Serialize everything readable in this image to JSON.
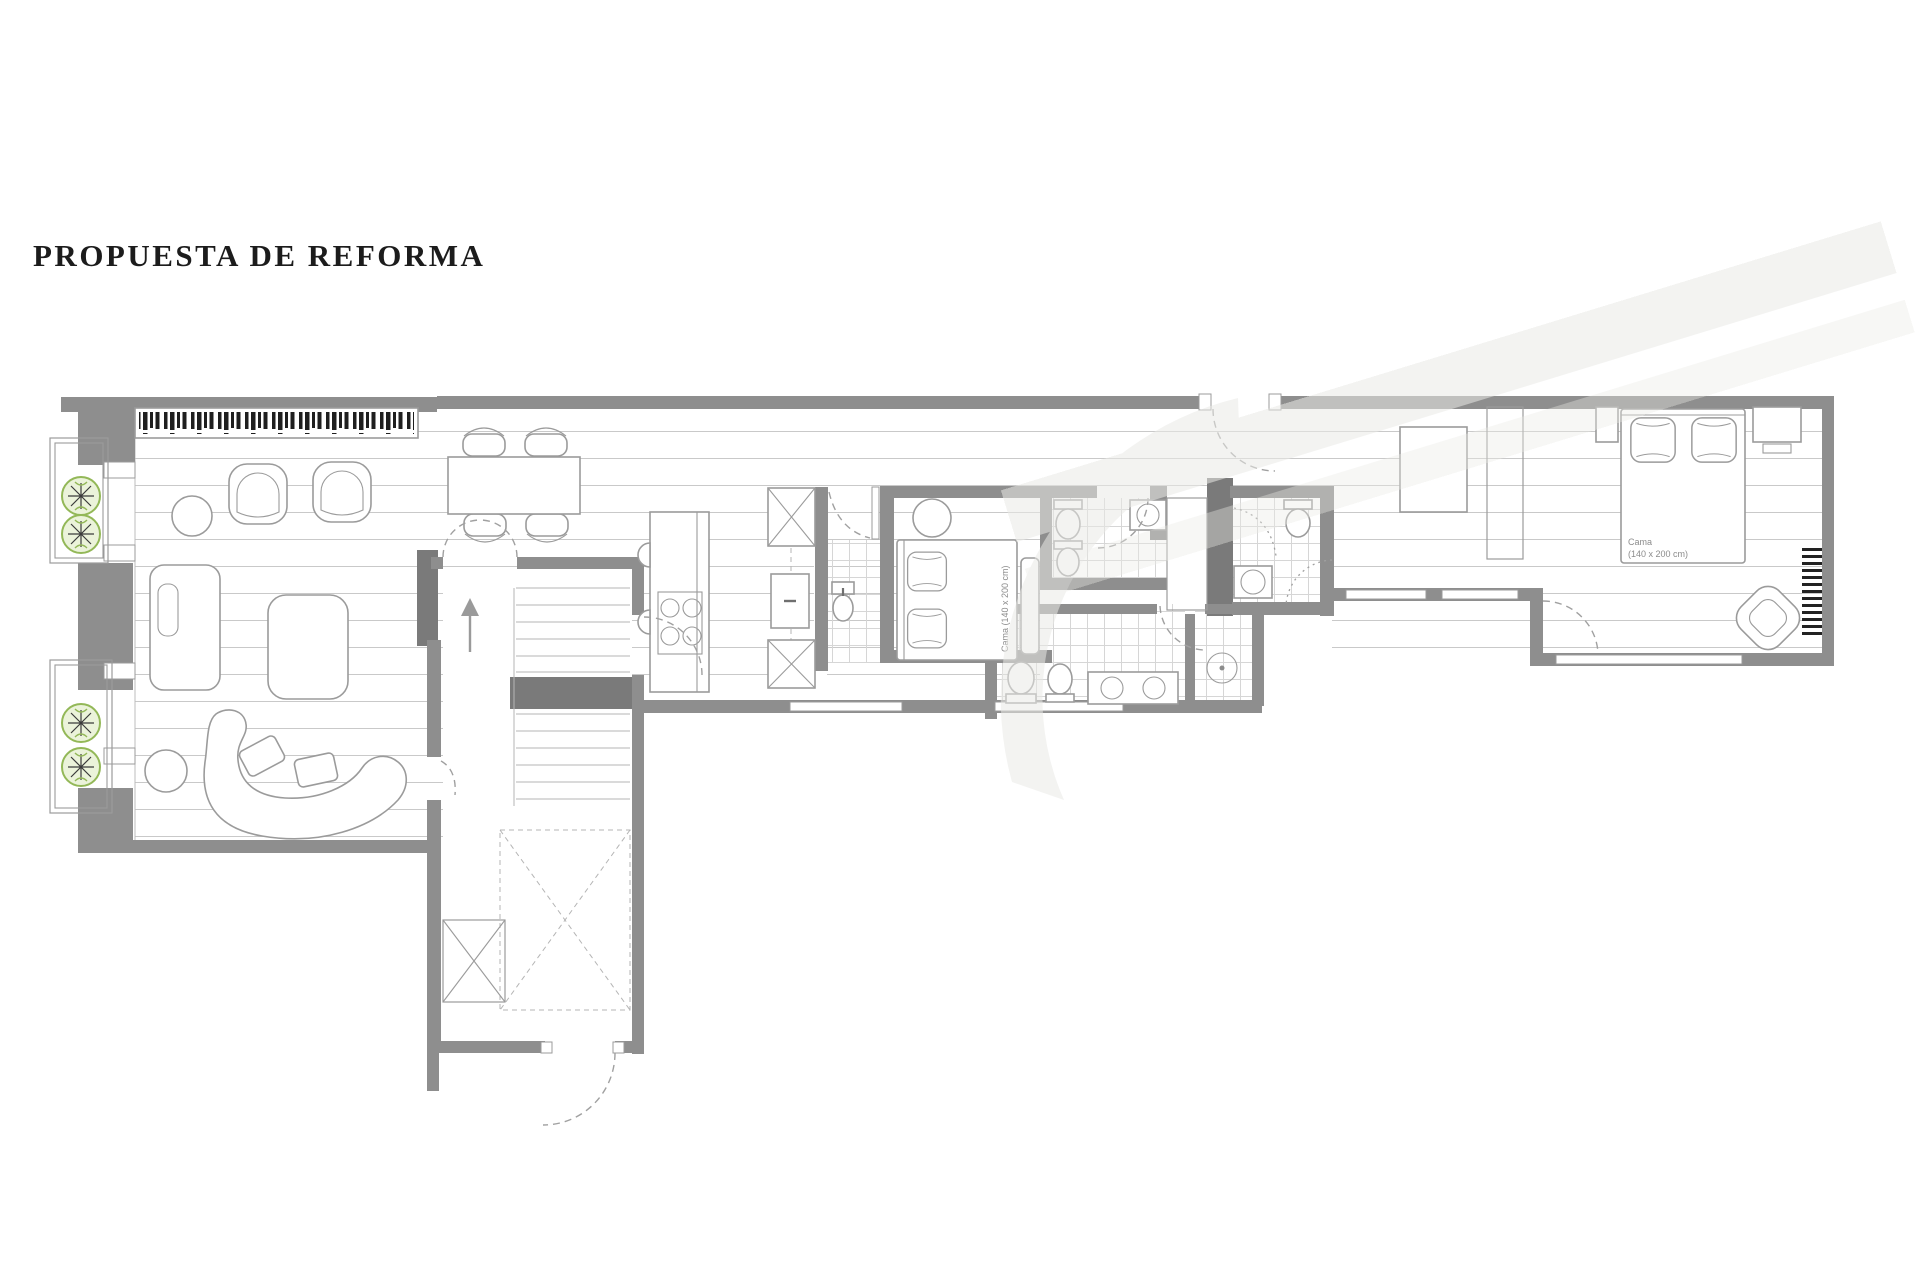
{
  "title": "PROPUESTA DE REFORMA",
  "plan": {
    "labels": {
      "middle_bed": "Cama (140 x 200 cm)",
      "master_bed_name": "Cama",
      "master_bed_size": "(140 x 200 cm)"
    },
    "colors": {
      "paper": "#ffffff",
      "wall": "#8e8e8e",
      "wall-dark": "#7a7a7a",
      "line": "#9b9b9b",
      "floor-line": "#c9c9c9",
      "tile-line": "#d6d6d6",
      "door-arc": "#a0a0a0",
      "books": "#1f1f1f",
      "plant-stroke": "#93b858",
      "plant-fill": "#ebf3da",
      "radiator": "#222222",
      "watermark": "#e9e9e6",
      "title-text": "#1c1c1c",
      "label-text": "#8c8c8c"
    },
    "icons": {
      "stairs_direction": "up-arrow-icon",
      "balcony_plants": "plant-icon",
      "background_mark": "script-swirl-watermark"
    }
  }
}
